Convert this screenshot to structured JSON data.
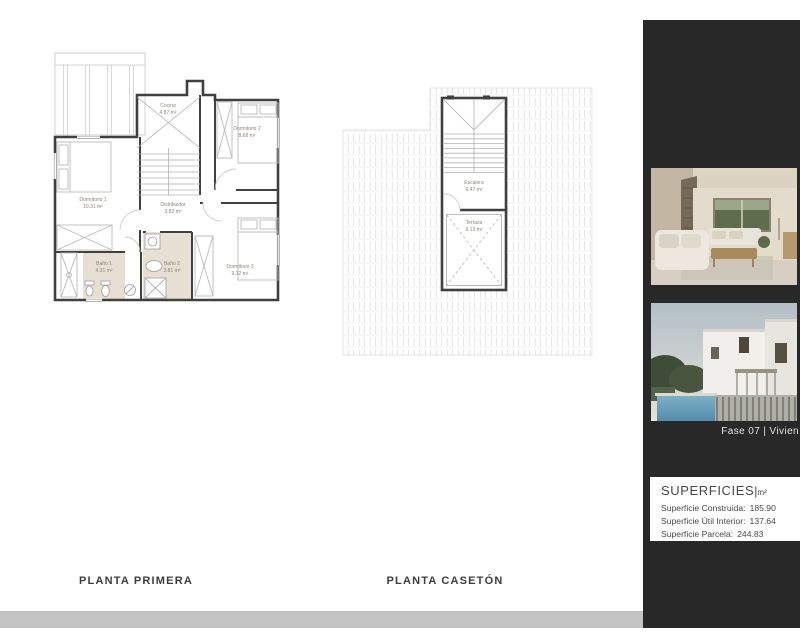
{
  "document": {
    "plans": [
      {
        "title": "PLANTA PRIMERA",
        "rooms": [
          {
            "name": "Cocina",
            "area": "4.87 m²"
          },
          {
            "name": "Dormitorio 2",
            "area": "8.68 m²"
          },
          {
            "name": "Dormitorio 1",
            "area": "10.31 m²"
          },
          {
            "name": "Distribuidor",
            "area": "3.82 m²"
          },
          {
            "name": "Baño 1",
            "area": "4.31 m²"
          },
          {
            "name": "Baño 2",
            "area": "3.81 m²"
          },
          {
            "name": "Dormitorio 3",
            "area": "9.12 m²"
          }
        ]
      },
      {
        "title": "PLANTA CASETÓN",
        "rooms": [
          {
            "name": "Escalera",
            "area": "6.47 m²"
          },
          {
            "name": "Terraza",
            "area": "9.13 m²"
          }
        ]
      }
    ]
  },
  "sidebar": {
    "caption": "Fase 07 | Vivien",
    "superficies": {
      "heading": "SUPERFICIES",
      "divider": "|",
      "unit": "m²",
      "rows": [
        {
          "label": "Superficie Construida:",
          "value": "185.90"
        },
        {
          "label": "Superficie Útil Interior:",
          "value": "137.64"
        },
        {
          "label": "Superficie Parcela:",
          "value": "244.83"
        }
      ]
    },
    "photos": [
      {
        "name": "interior-living-room"
      },
      {
        "name": "exterior-villa-pool"
      }
    ]
  },
  "colors": {
    "sidebar_bg": "#282828",
    "bottom_band": "#c3c3c3",
    "wall": "#404040",
    "bath_floor": "#e7dfd2",
    "title_text": "#3d3d3d"
  }
}
